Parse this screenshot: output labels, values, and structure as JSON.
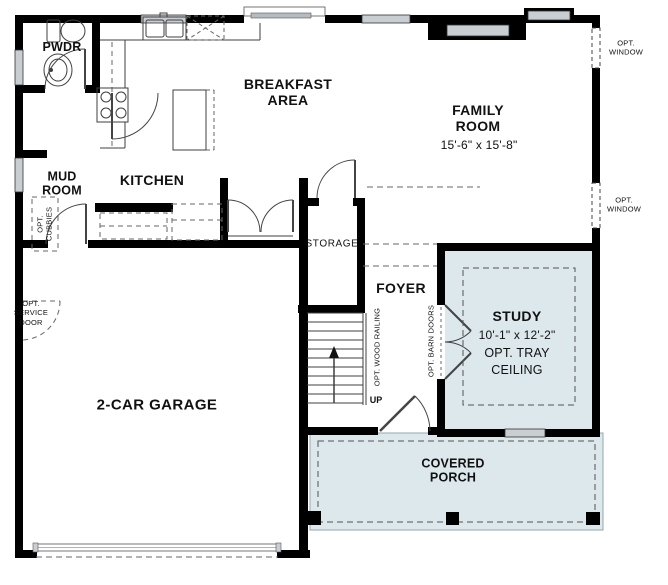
{
  "rooms": {
    "pwdr": {
      "label": "PWDR"
    },
    "mud_room": {
      "label": "MUD\nROOM"
    },
    "kitchen": {
      "label": "KITCHEN"
    },
    "breakfast_area": {
      "label": "BREAKFAST\nAREA"
    },
    "family_room": {
      "label": "FAMILY\nROOM",
      "dims": "15'-6\" x 15'-8\""
    },
    "storage": {
      "label": "STORAGE"
    },
    "foyer": {
      "label": "FOYER"
    },
    "study": {
      "label": "STUDY",
      "dims": "10'-1\" x 12'-2\"",
      "note": "OPT. TRAY\nCEILING"
    },
    "garage": {
      "label": "2-CAR GARAGE"
    },
    "covered_porch": {
      "label": "COVERED\nPORCH"
    }
  },
  "annotations": {
    "opt_window_upper": "OPT.\nWINDOW",
    "opt_window_lower": "OPT.\nWINDOW",
    "opt_cubbies": "OPT.\nCUBBIES",
    "opt_service_door": "OPT.\nSERVICE\nDOOR",
    "opt_wood_railing": "OPT. WOOD RAILING",
    "opt_barn_doors": "OPT. BARN DOORS",
    "up": "UP"
  },
  "colors": {
    "wall": "#000000",
    "room_fill": "#dce8ec",
    "window_fill": "#c9ced3",
    "line": "#3f3f3f",
    "dash": "#666666"
  }
}
